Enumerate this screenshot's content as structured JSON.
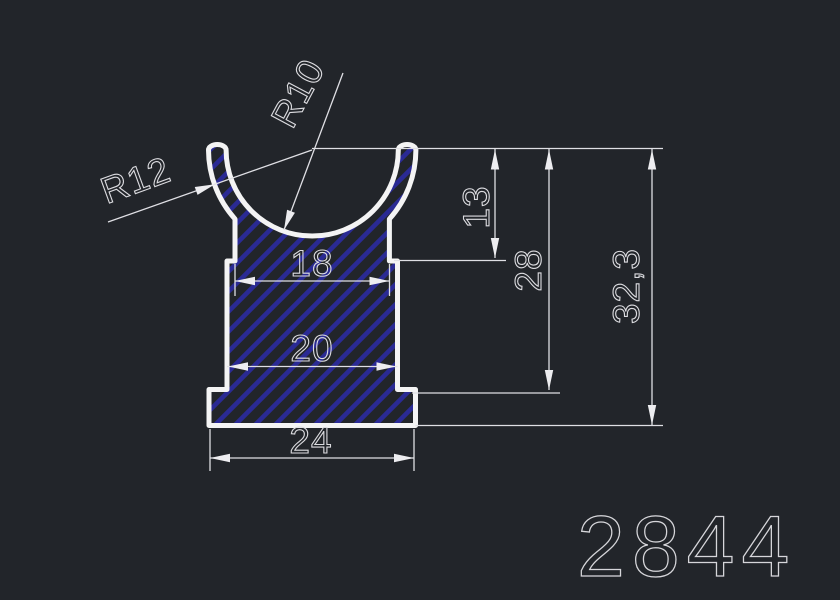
{
  "drawing": {
    "part_number": "2844",
    "radii": {
      "inner": "R10",
      "outer": "R12"
    },
    "widths": {
      "top": "18",
      "body": "20",
      "base": "24"
    },
    "heights": {
      "lip": "13",
      "body": "28",
      "total": "32,3"
    },
    "colors": {
      "background": "#22252a",
      "outline": "#f4f4f4",
      "hatch": "#2a2a94",
      "dimension_lines": "#dfdfe4",
      "dimension_text": "#dcdce0",
      "part_number_text": "#d6d6da"
    }
  }
}
